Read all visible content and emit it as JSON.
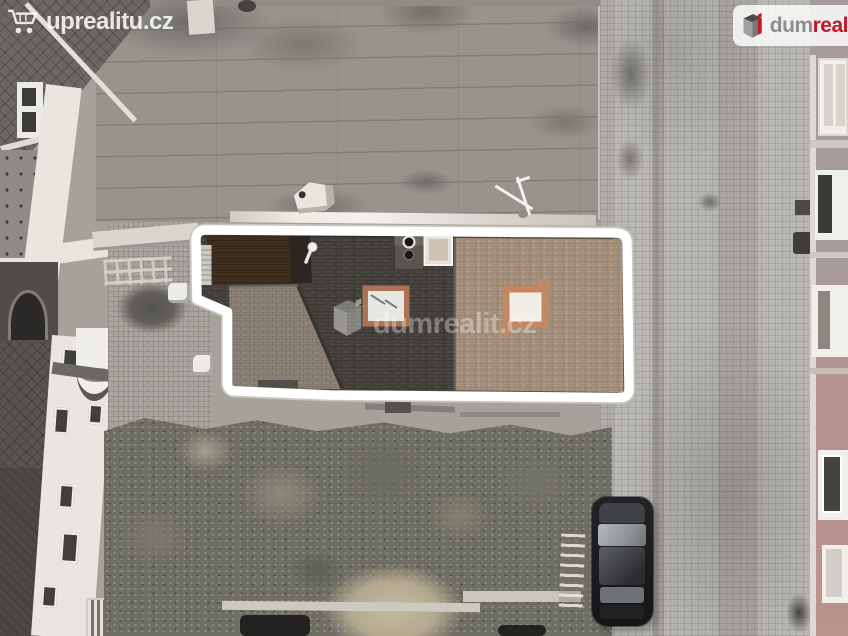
{
  "watermarks": {
    "top_left": {
      "icon": "shopping-cart-icon",
      "text": "uprealitu.cz",
      "color": "#ffffff"
    },
    "center": {
      "icon": "dumreality-cube-icon",
      "text": "dumrealit.cz",
      "color": "#ffffff"
    },
    "logo_badge": {
      "icon": "dumreality-cube-icon",
      "text_part_gray": "dum",
      "text_part_red": "real",
      "gray": "#8d8d8d",
      "red": "#c2182b",
      "background": "#ffffff"
    }
  },
  "highlight": {
    "outline_color": "#ffffff",
    "halo_color": "#c9c6c0"
  },
  "scene": {
    "type": "aerial-drone-photo",
    "labels": {
      "property": "highlighted-roof-property",
      "street": "cobblestone-street",
      "trees": "garden-tree-canopy",
      "car": "parked-dark-car",
      "flat_roof": "large-flat-gray-roof"
    }
  }
}
